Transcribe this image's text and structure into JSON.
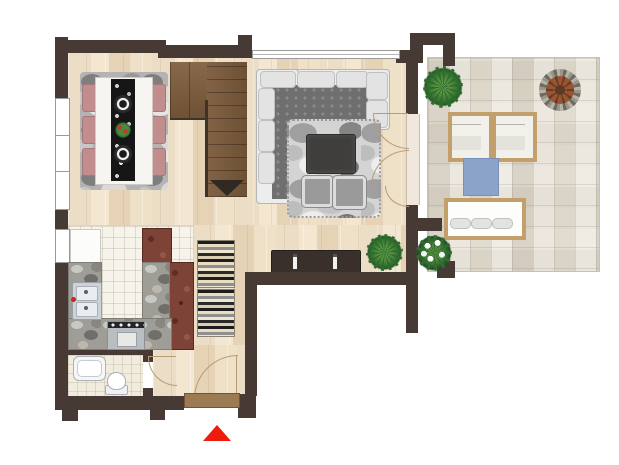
{
  "title": "apartment-floor-plan",
  "legend": {
    "entrance_marker": "red triangle below entrance door"
  },
  "palette": {
    "wall": "#473a35",
    "wood_floor": "#ecdcc3",
    "stair_wood": "#7b5a3a",
    "terrace_tile": "#e8e4d9",
    "kitchen_tile": "#f6f3ea",
    "chair_pink": "#c18d8d",
    "mat_blue": "#8ba3c9",
    "marker_red": "#ee1c0c"
  },
  "rooms": [
    {
      "name": "dining-area",
      "furniture": [
        "camo area rug",
        "dining table",
        "black ornamental table runner",
        "2 place settings",
        "flower centerpiece",
        "6 pink chairs"
      ]
    },
    {
      "name": "living-room",
      "furniture": [
        "L-shaped sectional sofa",
        "pebble rug",
        "dark coffee table",
        "2 poufs",
        "dark sideboard with 2 candlesticks",
        "potted plant"
      ]
    },
    {
      "name": "staircase",
      "furniture": [
        "wood treads",
        "down direction arrow"
      ]
    },
    {
      "name": "kitchen",
      "furniture": [
        "refrigerator",
        "double basin sink",
        "stove with oven",
        "granite counters",
        "tall wood cabinets"
      ]
    },
    {
      "name": "hallway",
      "furniture": [
        "wave pattern runner rug",
        "entrance door with threshold"
      ]
    },
    {
      "name": "bathroom",
      "furniture": [
        "bathtub",
        "toilet"
      ]
    },
    {
      "name": "terrace",
      "furniture": [
        "2 sun loungers",
        "garden bench with 3 cushions",
        "blue mat",
        "round fire bowl",
        "green potted plant",
        "white flowering plant"
      ]
    }
  ],
  "windows": [
    "dining left wall",
    "kitchen left wall",
    "living room top wall"
  ],
  "doors": [
    "entrance door",
    "bathroom door",
    "terrace french doors (3 leaves)"
  ]
}
